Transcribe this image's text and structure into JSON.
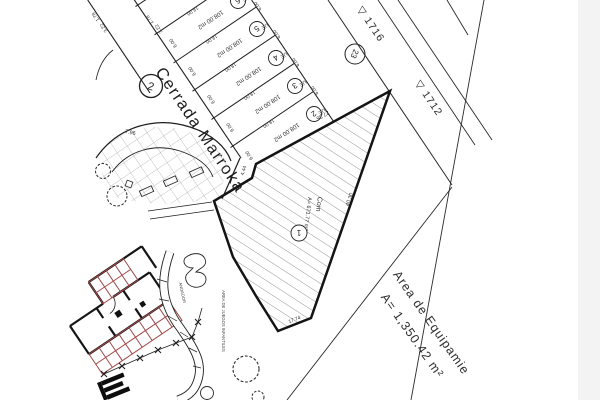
{
  "street": {
    "name": "Cerrada Marroka",
    "circle": "2"
  },
  "lots": {
    "area": "108.00 m2",
    "depth": "18.00",
    "width": "6.00",
    "use": "UE",
    "numbers": [
      "6",
      "5",
      "4",
      "3",
      "2"
    ],
    "dim_a": "3.22",
    "dim_b": "1.78"
  },
  "lot23": {
    "number": "23"
  },
  "parcel": {
    "use": "Com",
    "area": "A= 671.77 m2",
    "number": "1",
    "dim_top": "27.36",
    "dim_right": "40.30",
    "dim_bottom": "17.74",
    "dim_step": "4.44"
  },
  "equip": {
    "line1": "Area de Equipamie",
    "line2": "A= 1,350.42 m²"
  },
  "benchmarks": {
    "b1716": "▽ 1716",
    "b1712": "▽ 1712"
  },
  "misc": {
    "playground": "AREA DE JUEGOS INFANTILES",
    "walkway": "ANDADOR",
    "plaza_dim": "7.96"
  },
  "colors": {
    "line": "#1f1f1f",
    "hatch": "#8a8a8a",
    "building_red": "#a04848"
  }
}
